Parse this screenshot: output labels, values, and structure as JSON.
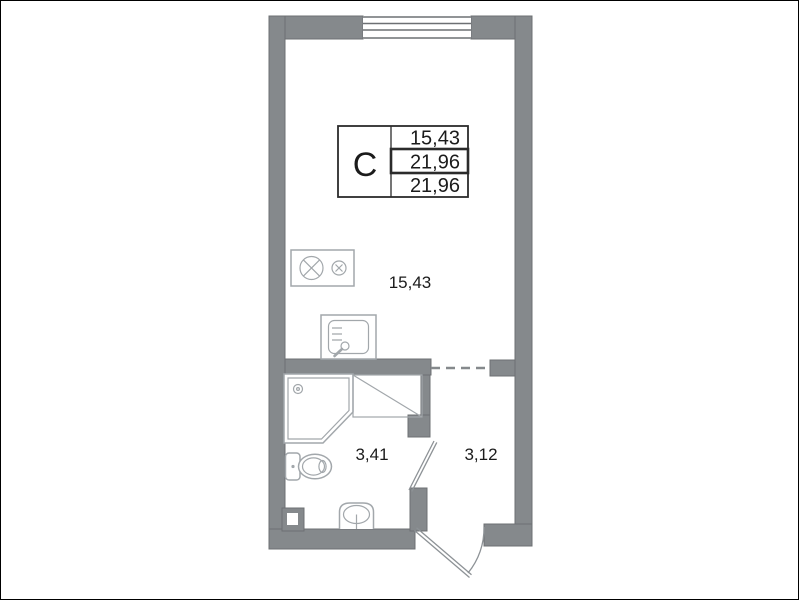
{
  "colors": {
    "wall": "#85898c",
    "wall_edge": "#6d7073",
    "fixture": "#a2a7ab",
    "door": "#8d9296",
    "ink": "#1b1b1b",
    "table_border": "#2b2b2b"
  },
  "legend": {
    "type": "С",
    "values": [
      "15,43",
      "21,96",
      "21,96"
    ]
  },
  "rooms": {
    "living": {
      "label": "15,43"
    },
    "bathroom": {
      "label": "3,41"
    },
    "hallway": {
      "label": "3,12"
    }
  },
  "fixtures": [
    "window",
    "stove",
    "kitchen-sink",
    "shower",
    "closet",
    "toilet",
    "washbasin",
    "vent-shaft",
    "entrance-door",
    "bathroom-door"
  ]
}
